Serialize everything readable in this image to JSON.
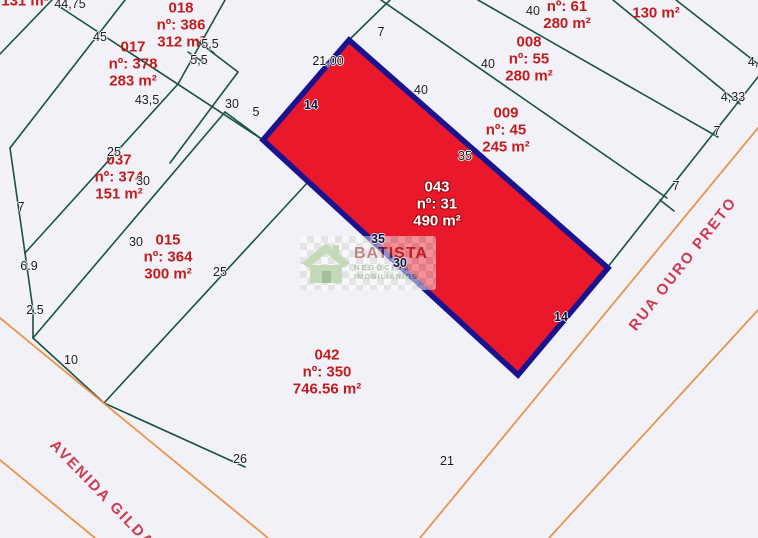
{
  "colors": {
    "background": "#f2f1f7",
    "parcel_line": "#175243",
    "street_line": "#e8954a",
    "highlight_fill": "#e9192b",
    "highlight_border": "#1a1390",
    "lot_text": "#c31c1c",
    "street_text": "#cf3a50",
    "dimension_text": "#1c1c1c"
  },
  "highlight_lot": {
    "polygon": "349,40 608,268 518,375 263,140"
  },
  "map": {
    "green_lines": [
      [
        0,
        54,
        52,
        0
      ],
      [
        10,
        148,
        125,
        0
      ],
      [
        10,
        148,
        25,
        253
      ],
      [
        25,
        253,
        33,
        310
      ],
      [
        33,
        310,
        33,
        338
      ],
      [
        33,
        338,
        104,
        403
      ],
      [
        104,
        403,
        245,
        467
      ],
      [
        104,
        403,
        308,
        182
      ],
      [
        33,
        338,
        225,
        112
      ],
      [
        25,
        253,
        178,
        84
      ],
      [
        57,
        5,
        263,
        140
      ],
      [
        178,
        84,
        225,
        0
      ],
      [
        196,
        40,
        214,
        53
      ],
      [
        188,
        52,
        206,
        64
      ],
      [
        238,
        72,
        196,
        40
      ],
      [
        238,
        72,
        170,
        163
      ],
      [
        225,
        112,
        263,
        140
      ],
      [
        349,
        40,
        390,
        0
      ],
      [
        381,
        0,
        667,
        198
      ],
      [
        478,
        0,
        718,
        137
      ],
      [
        613,
        0,
        740,
        104
      ],
      [
        676,
        0,
        758,
        64
      ],
      [
        607,
        268,
        758,
        77
      ],
      [
        660,
        200,
        674,
        211
      ]
    ],
    "orange_lines": [
      [
        0,
        318,
        268,
        538
      ],
      [
        0,
        460,
        95,
        538
      ],
      [
        420,
        538,
        758,
        128
      ],
      [
        549,
        538,
        758,
        310
      ]
    ]
  },
  "lots": [
    {
      "id": "corner-cut",
      "x": 25,
      "y": 1,
      "lines": [
        "131 m²"
      ],
      "onred": false
    },
    {
      "id": "018",
      "x": 181,
      "y": 8,
      "lines": [
        "018",
        "nº: 386",
        "312 m²"
      ],
      "onred": false
    },
    {
      "id": "017",
      "x": 133,
      "y": 47,
      "lines": [
        "017",
        "nº: 378",
        "283 m²"
      ],
      "onred": false
    },
    {
      "id": "top-cut",
      "x": 567,
      "y": 6,
      "lines": [
        "nº: 61",
        "280 m²"
      ],
      "onred": false
    },
    {
      "id": "130",
      "x": 656,
      "y": 13,
      "lines": [
        "130 m²"
      ],
      "onred": false
    },
    {
      "id": "008",
      "x": 529,
      "y": 42,
      "lines": [
        "008",
        "nº: 55",
        "280 m²"
      ],
      "onred": false
    },
    {
      "id": "009",
      "x": 506,
      "y": 113,
      "lines": [
        "009",
        "nº: 45",
        "245 m²"
      ],
      "onred": false
    },
    {
      "id": "043",
      "x": 437,
      "y": 187,
      "lines": [
        "043",
        "nº: 31",
        "490 m²"
      ],
      "onred": true
    },
    {
      "id": "037",
      "x": 119,
      "y": 160,
      "lines": [
        "037",
        "nº: 374",
        "151 m²"
      ],
      "onred": false
    },
    {
      "id": "015",
      "x": 168,
      "y": 240,
      "lines": [
        "015",
        "nº: 364",
        "300 m²"
      ],
      "onred": false
    },
    {
      "id": "042",
      "x": 327,
      "y": 355,
      "lines": [
        "042",
        "nº: 350",
        "746.56 m²"
      ],
      "onred": false
    }
  ],
  "dimensions": [
    {
      "t": "44,75",
      "x": 70,
      "y": 4
    },
    {
      "t": "45",
      "x": 100,
      "y": 37
    },
    {
      "t": "5,5",
      "x": 210,
      "y": 44
    },
    {
      "t": "5,5",
      "x": 199,
      "y": 60
    },
    {
      "t": "43,5",
      "x": 147,
      "y": 100
    },
    {
      "t": "30",
      "x": 232,
      "y": 104
    },
    {
      "t": "5",
      "x": 256,
      "y": 112
    },
    {
      "t": "21,00",
      "x": 328,
      "y": 61
    },
    {
      "t": "7",
      "x": 381,
      "y": 32
    },
    {
      "t": "14",
      "x": 311,
      "y": 105,
      "onred": true
    },
    {
      "t": "40",
      "x": 421,
      "y": 90
    },
    {
      "t": "40",
      "x": 488,
      "y": 64
    },
    {
      "t": "40",
      "x": 533,
      "y": 11
    },
    {
      "t": "4,33",
      "x": 733,
      "y": 97
    },
    {
      "t": "4,33",
      "x": 760,
      "y": 62
    },
    {
      "t": "7",
      "x": 717,
      "y": 131
    },
    {
      "t": "7",
      "x": 676,
      "y": 186
    },
    {
      "t": "35",
      "x": 465,
      "y": 156
    },
    {
      "t": "35",
      "x": 378,
      "y": 239,
      "onred": true
    },
    {
      "t": "30",
      "x": 400,
      "y": 263,
      "onred": true
    },
    {
      "t": "14",
      "x": 561,
      "y": 317,
      "onred": true
    },
    {
      "t": "25",
      "x": 114,
      "y": 152
    },
    {
      "t": "30",
      "x": 143,
      "y": 181
    },
    {
      "t": "7",
      "x": 21,
      "y": 207
    },
    {
      "t": "6.9",
      "x": 29,
      "y": 266
    },
    {
      "t": "30",
      "x": 136,
      "y": 242
    },
    {
      "t": "25",
      "x": 220,
      "y": 272
    },
    {
      "t": "2.5",
      "x": 35,
      "y": 310
    },
    {
      "t": "10",
      "x": 71,
      "y": 360
    },
    {
      "t": "26",
      "x": 240,
      "y": 459
    },
    {
      "t": "21",
      "x": 447,
      "y": 461
    }
  ],
  "streets": [
    {
      "name": "AVENIDA GILDA",
      "x": 102,
      "y": 494,
      "angle": 46
    },
    {
      "name": "RUA OURO PRETO",
      "x": 683,
      "y": 264,
      "angle": -52
    }
  ],
  "watermark": {
    "line1": "BATISTA",
    "line2": "NEGÓCIOS",
    "line3": "IMOBILIÁRIOS"
  }
}
